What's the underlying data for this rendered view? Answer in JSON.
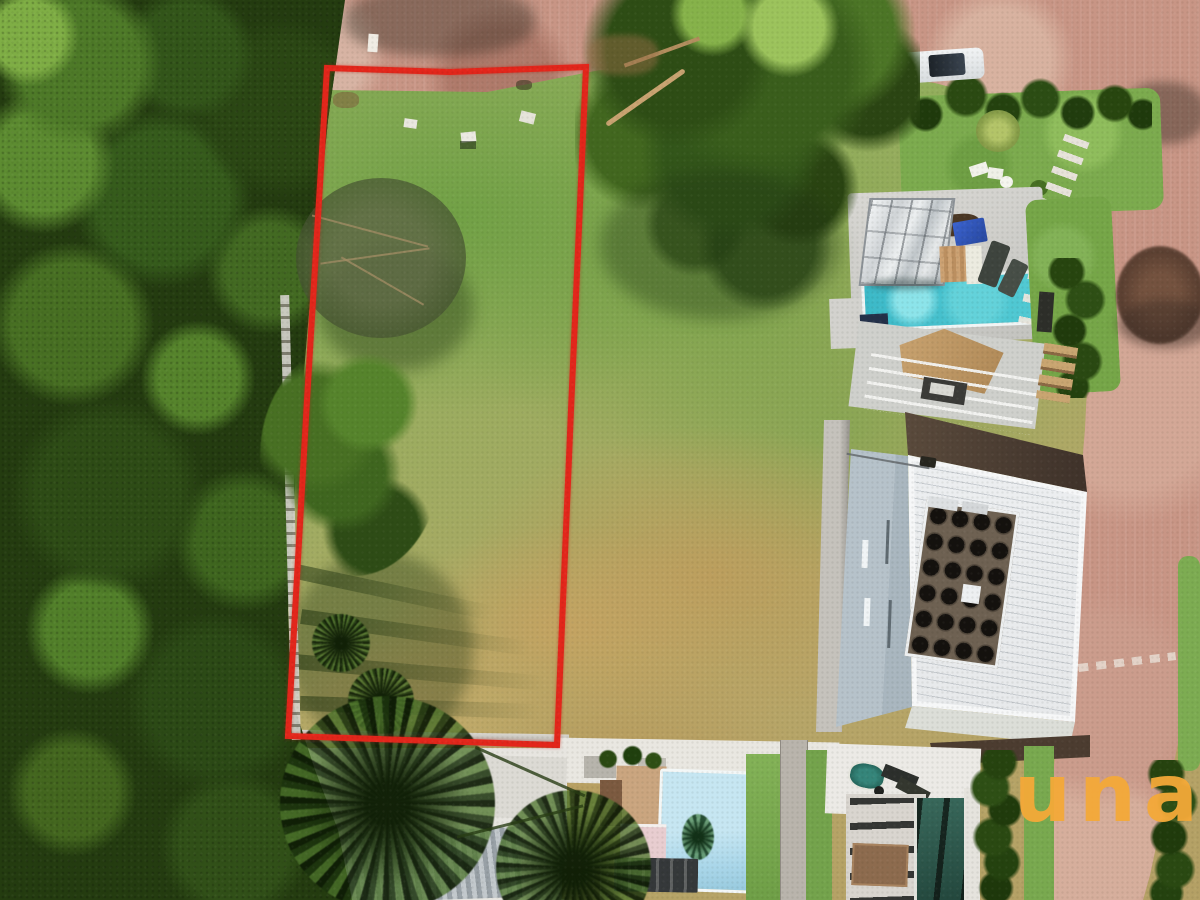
{
  "watermark": {
    "text": "una",
    "color": "#F2A93B"
  },
  "plot_boundary": {
    "color": "#E3261B",
    "stroke_width": 6,
    "points": "327,68 450,72 586,67 571,410 557,745 288,736 307,400"
  },
  "palette": {
    "forest_green": "#243C10",
    "canopy_light": "#6F9F3C",
    "field_green": "#8FAE5B",
    "field_dry_tan": "#C2A76B",
    "road_pink": "#C89585",
    "pool_turquoise": "#4AC4CF",
    "pool_light_blue": "#B4DFEF",
    "pool_dark_teal": "#2F5F54",
    "roof_white": "#EDEFF1",
    "roof_dark_brown": "#4C3C30",
    "house_wall_blue_gray": "#B6C2CA",
    "lawn_green": "#7CAB4E"
  },
  "scene": {
    "kind": "aerial-drone-photo",
    "subject": "vacant grass land plot outlined in red, forest at left, brick roads top and right, neighboring houses with pools"
  }
}
